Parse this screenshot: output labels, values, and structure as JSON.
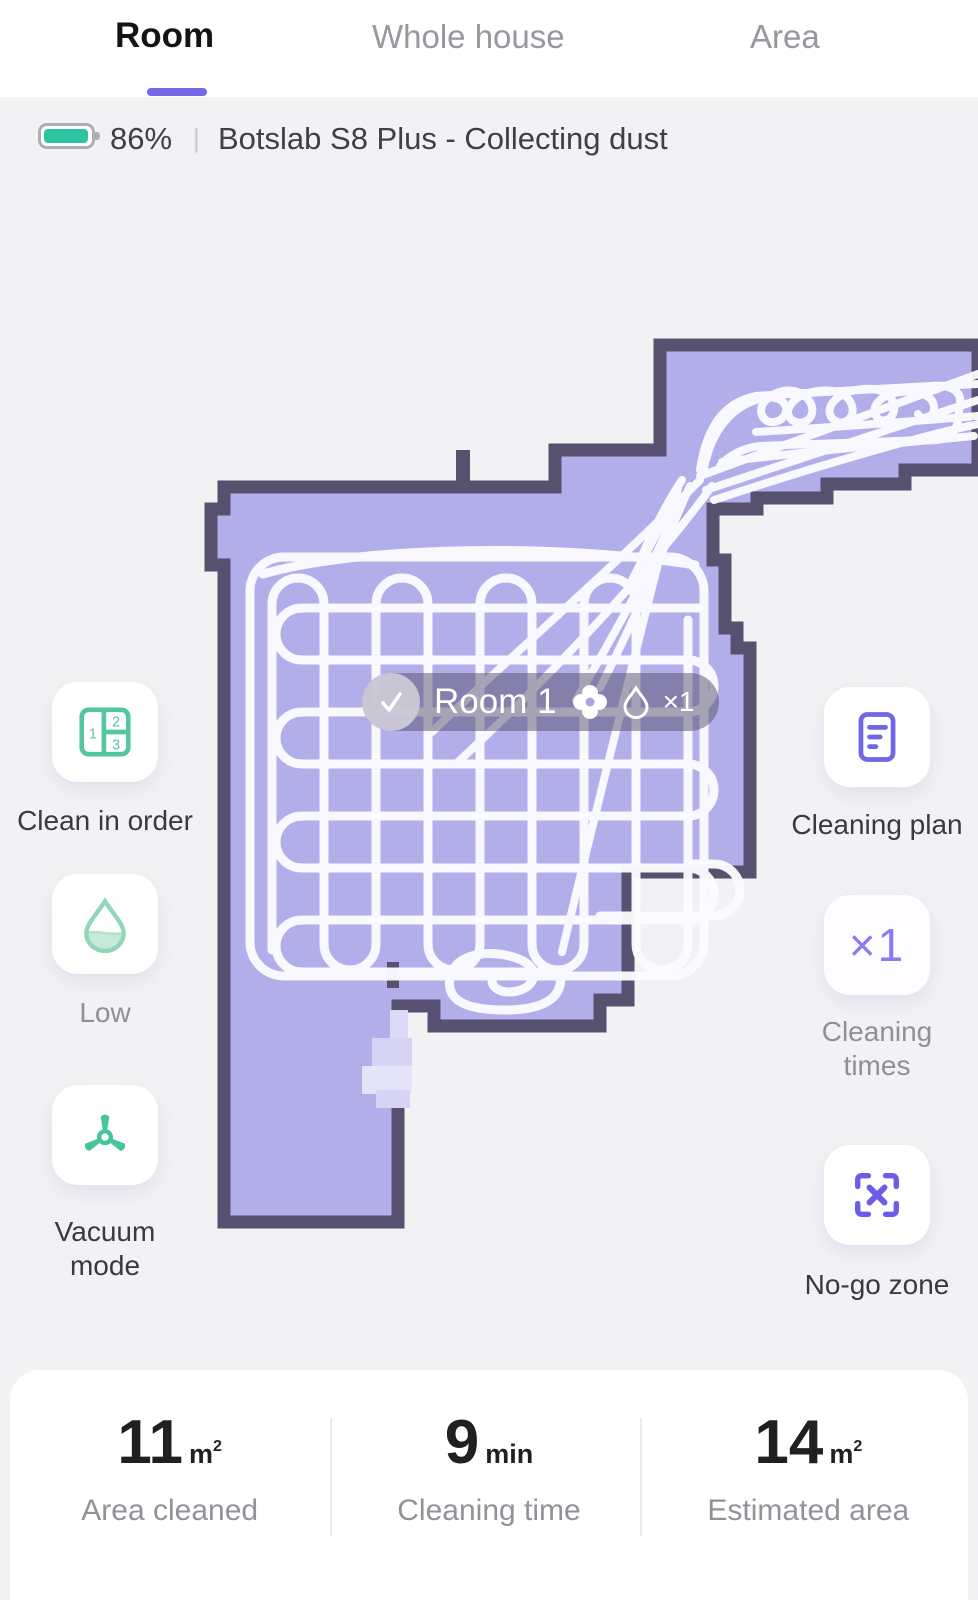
{
  "tabs": {
    "items": [
      {
        "label": "Room",
        "active": true
      },
      {
        "label": "Whole house",
        "active": false
      },
      {
        "label": "Area",
        "active": false
      }
    ]
  },
  "status": {
    "battery": "86%",
    "separator": "|",
    "device_status": "Botslab S8 Plus - Collecting dust"
  },
  "map": {
    "pill": {
      "room": "Room 1",
      "count": "×1"
    }
  },
  "actions": {
    "order_numbers": {
      "one": "1",
      "two": "2",
      "three": "3"
    },
    "left": [
      {
        "label": "Clean in order"
      },
      {
        "label": "Low"
      },
      {
        "label": "Vacuum mode"
      }
    ],
    "right": [
      {
        "label": "Cleaning plan"
      },
      {
        "value": "×1",
        "label": "Cleaning times"
      },
      {
        "label": "No-go zone"
      }
    ]
  },
  "stats": {
    "items": [
      {
        "value": "11",
        "unit": "m",
        "unit_sup": "2",
        "label": "Area cleaned"
      },
      {
        "value": "9",
        "unit": "min",
        "unit_sup": "",
        "label": "Cleaning time"
      },
      {
        "value": "14",
        "unit": "m",
        "unit_sup": "2",
        "label": "Estimated area"
      }
    ]
  },
  "colors": {
    "accent_purple": "#7668e6",
    "icon_purple": "#7165e8",
    "icon_green": "#54c7a0",
    "battery_green": "#2cc5a2",
    "map_floor": "#b2aeea",
    "map_wall": "#57506e",
    "path_white": "#fcfcff"
  }
}
